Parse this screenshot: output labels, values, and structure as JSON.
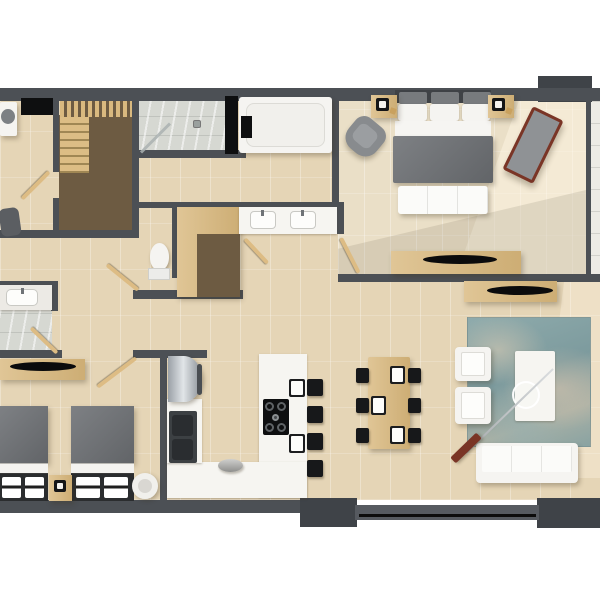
{
  "scene": {
    "kind": "3d-rendered-floor-plan",
    "background": "#ffffff",
    "orientation": "top-down"
  },
  "palette": {
    "wall": "#4c5055",
    "wall_dark": "#3f4348",
    "floor_tile": "#e5d5b6",
    "bedroom_tile": "#eadfc7",
    "marble": "#d6d8d2",
    "balcony_tile": "#edebe5",
    "wood_light": "#d9b97f",
    "wood_dark": "#6d5b42",
    "counter_white": "#f6f5f1",
    "fabric_gray": "#6f7276",
    "rug_teal": "#8fabac",
    "accent_red_brown": "#7a3526",
    "appliance_black": "#121315",
    "steel": "#c6cbce"
  },
  "rooms": [
    {
      "name": "laundry-room",
      "furniture": [
        "washing-machine",
        "black-counter",
        "door",
        "utility-sink"
      ]
    },
    {
      "name": "staircase",
      "furniture": [
        "upper-flight",
        "lower-flight",
        "stair-void"
      ]
    },
    {
      "name": "shower-room",
      "furniture": [
        "walk-in-shower",
        "glass-screen",
        "drain"
      ]
    },
    {
      "name": "main-bathroom",
      "furniture": [
        "bathtub",
        "bath-caddy",
        "double-sink-vanity",
        "toilet",
        "built-in-wardrobe",
        "doors"
      ]
    },
    {
      "name": "master-bedroom",
      "furniture": [
        "double-bed",
        "headboard-cushions",
        "foot-bench",
        "nightstand-left",
        "nightstand-right",
        "table-lamps",
        "armchair",
        "chaise-lounge",
        "tv-console",
        "curved-tv",
        "door"
      ]
    },
    {
      "name": "second-bedroom",
      "furniture": [
        "twin-bed-left",
        "twin-bed-right",
        "shared-nightstand",
        "table-lamp",
        "round-pouf",
        "tv-console",
        "curved-tv",
        "door"
      ]
    },
    {
      "name": "second-bathroom",
      "furniture": [
        "sink-counter",
        "door"
      ]
    },
    {
      "name": "kitchen",
      "furniture": [
        "fridge",
        "double-basin-sink",
        "l-shaped-counter",
        "peninsula-island",
        "gas-hob",
        "bar-stools-x4",
        "island-place-settings-x2",
        "waste-bin"
      ]
    },
    {
      "name": "living-dining-room",
      "furniture": [
        "dining-table",
        "dining-chairs-x6",
        "place-settings-x3",
        "area-rug",
        "coffee-table",
        "round-tray",
        "armchairs-x2",
        "three-seat-sofa",
        "arc-floor-lamp",
        "tv-console",
        "curved-tv",
        "sliding-glass-door"
      ]
    },
    {
      "name": "balcony",
      "furniture": []
    }
  ]
}
